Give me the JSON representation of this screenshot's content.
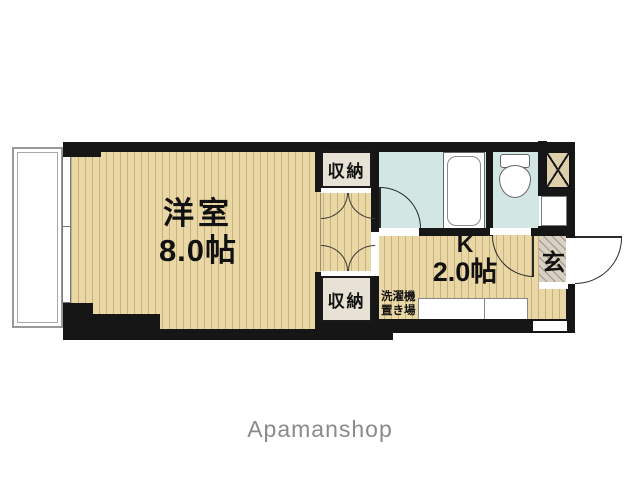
{
  "brand": {
    "label": "Apamanshop"
  },
  "floorplan": {
    "colors": {
      "wall": "#161616",
      "floor": "#ead7a6",
      "floor_stripe": "#c9b17c",
      "water": "#d2e6e3",
      "closet_fill": "#e7e2d5",
      "genkan_fill": "#d7d0c3",
      "ps_fill": "#ddcfac"
    },
    "rooms": {
      "main_room": {
        "name": "洋室",
        "size": "8.0帖"
      },
      "kitchen": {
        "name": "K",
        "size": "2.0帖"
      },
      "closet_top": {
        "label": "収納"
      },
      "closet_bottom": {
        "label": "収納"
      },
      "entrance": {
        "label": "玄"
      },
      "laundry": {
        "line1": "洗濯機",
        "line2": "置き場"
      }
    }
  }
}
